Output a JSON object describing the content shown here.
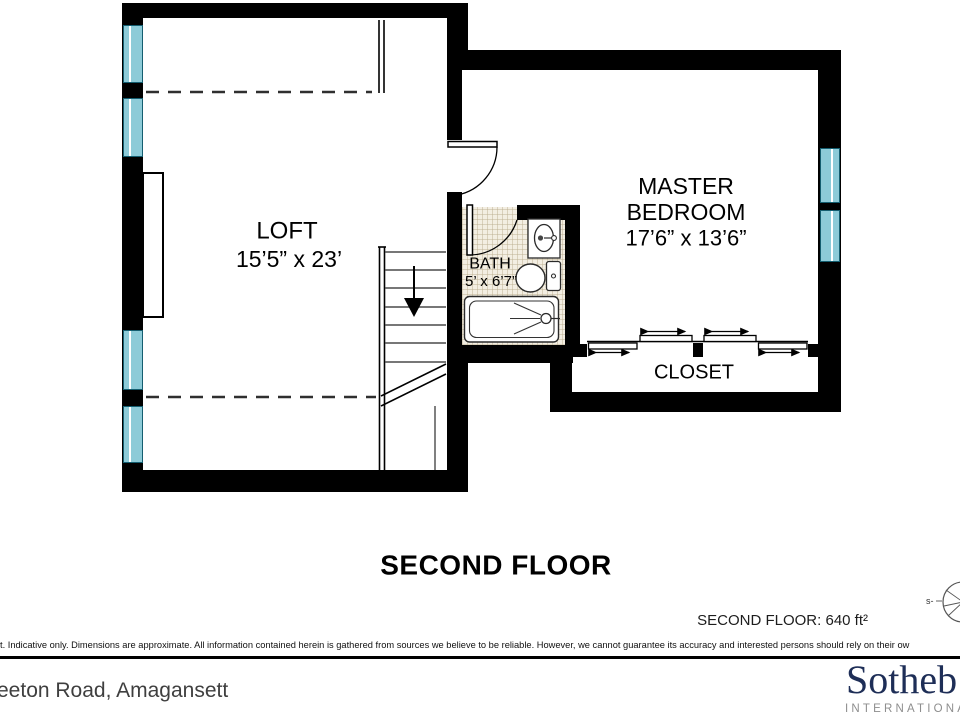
{
  "plan": {
    "rooms": {
      "loft": {
        "name": "LOFT",
        "dims": "15’5” x 23’"
      },
      "master_bedroom": {
        "name_line1": "MASTER",
        "name_line2": "BEDROOM",
        "dims": "17’6” x 13’6”"
      },
      "bath": {
        "name": "BATH",
        "dims": "5’ x 6’7”"
      },
      "closet": {
        "name": "CLOSET"
      }
    },
    "floor_title": "SECOND FLOOR",
    "floor_area": "SECOND FLOOR: 640 ft²",
    "compass_label": "s-"
  },
  "footer": {
    "disclaimer": "t. Indicative only. Dimensions are approximate. All information contained herein is gathered from sources we believe to be reliable. However, we cannot guarantee its accuracy and interested persons should rely on their ow",
    "address": "eeton Road, Amagansett",
    "brand_name": "Sotheb",
    "brand_subtitle": "INTERNATIONAL"
  },
  "colors": {
    "wall": "#000000",
    "window_glass": "#8DCBD8",
    "bath_tile": "#F3EEE2",
    "brand_navy": "#1E2E57",
    "brand_gray": "#8E8E8E"
  }
}
